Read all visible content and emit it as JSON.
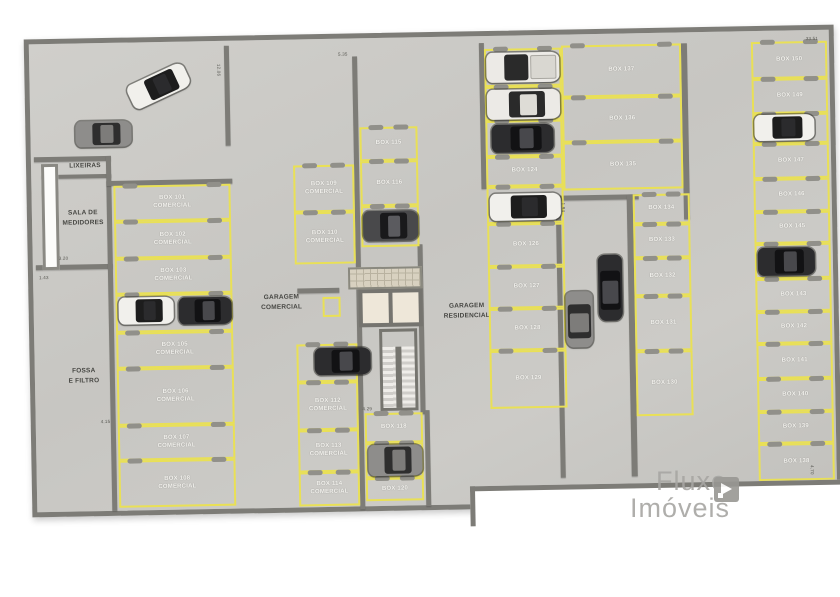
{
  "rooms": {
    "lixeiras": "LIXEIRAS",
    "sala_medidores": "SALA DE\nMEDIDORES",
    "fossa_filtro": "FOSSA\nE FILTRO",
    "garagem_comercial": "GARAGEM\nCOMERCIAL",
    "garagem_residencial": "GARAGEM\nRESIDENCIAL"
  },
  "boxes": {
    "b101": "BOX 101\nCOMERCIAL",
    "b102": "BOX 102\nCOMERCIAL",
    "b103": "BOX 103\nCOMERCIAL",
    "b105": "BOX 105\nCOMERCIAL",
    "b106": "BOX 106\nCOMERCIAL",
    "b107": "BOX 107\nCOMERCIAL",
    "b108": "BOX 108\nCOMERCIAL",
    "b109": "BOX 109\nCOMERCIAL",
    "b110": "BOX 110\nCOMERCIAL",
    "b112": "BOX 112\nCOMERCIAL",
    "b113": "BOX 113\nCOMERCIAL",
    "b114": "BOX 114\nCOMERCIAL",
    "b115": "BOX 115",
    "b116": "BOX 116",
    "b118": "BOX 118",
    "b120": "BOX 120",
    "b124": "BOX 124",
    "b126": "BOX 126",
    "b127": "BOX 127",
    "b128": "BOX 128",
    "b129": "BOX 129",
    "b130": "BOX 130",
    "b131": "BOX 131",
    "b132": "BOX 132",
    "b133": "BOX 133",
    "b134": "BOX 134",
    "b135": "BOX 135",
    "b136": "BOX 136",
    "b137": "BOX 137",
    "b138": "BOX 138",
    "b139": "BOX 139",
    "b140": "BOX 140",
    "b141": "BOX 141",
    "b142": "BOX 142",
    "b143": "BOX 143",
    "b145": "BOX 145",
    "b146": "BOX 146",
    "b147": "BOX 147",
    "b149": "BOX 149",
    "b150": "BOX 150"
  },
  "dimensions": {
    "top_left": "12.06",
    "top_mid": "5.35",
    "top_right": "33.51",
    "sala": "3.20",
    "left": "1.43",
    "fossa": "4.15",
    "mid": "4.29",
    "ramp": "1.94",
    "bottom_right": "4.70"
  },
  "watermark": {
    "line1": "Fluxo",
    "line2": "Imóveis"
  },
  "colors": {
    "floor": "#c9c8c4",
    "wall": "#7d7c77",
    "parking_line": "#e9e056"
  }
}
